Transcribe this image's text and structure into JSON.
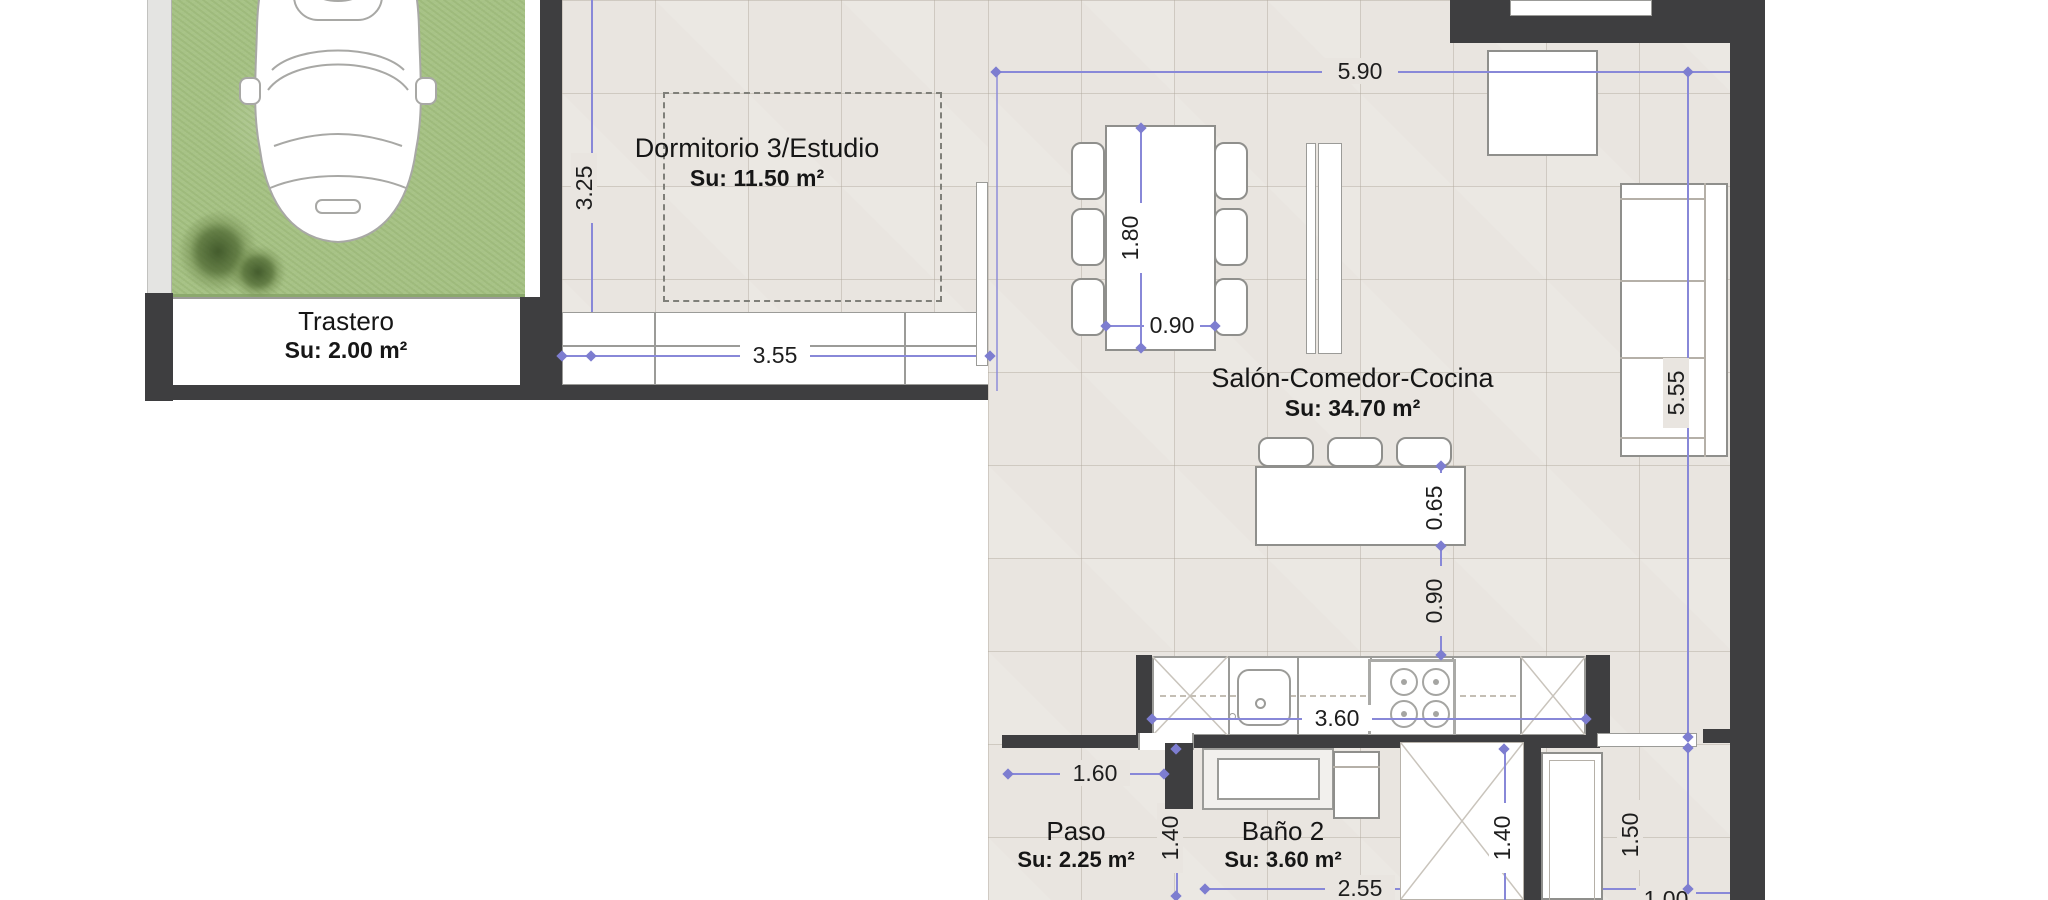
{
  "rooms": {
    "trastero": {
      "name": "Trastero",
      "area": "Su: 2.00 m²"
    },
    "dormitorio": {
      "name": "Dormitorio 3/Estudio",
      "area": "Su: 11.50 m²"
    },
    "salon": {
      "name": "Salón-Comedor-Cocina",
      "area": "Su: 34.70 m²"
    },
    "paso": {
      "name": "Paso",
      "area": "Su: 2.25 m²"
    },
    "bano2": {
      "name": "Baño 2",
      "area": "Su: 3.60 m²"
    }
  },
  "dimensions": {
    "dorm_height": "3.25",
    "dorm_window_width": "3.55",
    "salon_width": "5.90",
    "table_length": "1.80",
    "table_width": "0.90",
    "island_depth": "0.65",
    "island_clearance": "0.90",
    "counter_length": "3.60",
    "sofa_wall_length": "5.55",
    "paso_width": "1.60",
    "paso_depth": "1.40",
    "bano_width": "2.55",
    "closet_depth": "1.40",
    "entry_depth": "1.50",
    "entry_width": "1.00"
  },
  "colors": {
    "wall": "#3e3e40",
    "dimension_line": "#8888d8",
    "floor_tile": "#e9e5e0",
    "grass": "#a7c287"
  }
}
